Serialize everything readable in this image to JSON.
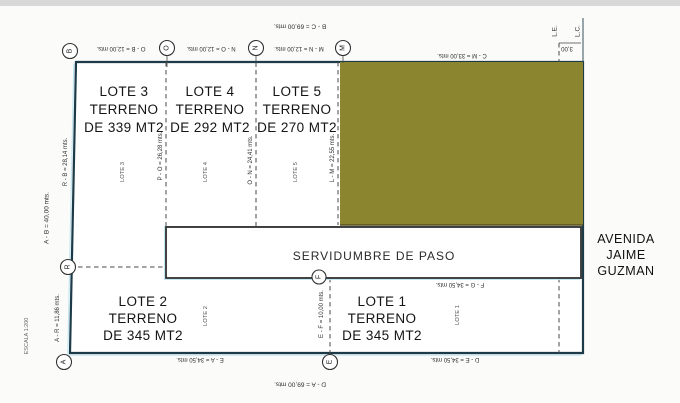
{
  "plan": {
    "servidumbre_label": "SERVIDUMBRE DE PASO",
    "avenue": {
      "l1": "AVENIDA",
      "l2": "JAIME",
      "l3": "GUZMAN"
    },
    "scale": "ESCALA 1:200",
    "lots": {
      "lote3": {
        "name": "LOTE 3",
        "l2": "TERRENO",
        "l3": "DE 339 MT2"
      },
      "lote4": {
        "name": "LOTE 4",
        "l2": "TERRENO",
        "l3": "DE 292 MT2"
      },
      "lote5": {
        "name": "LOTE 5",
        "l2": "TERRENO",
        "l3": "DE 270 MT2"
      },
      "lote2": {
        "name": "LOTE 2",
        "l2": "TERRENO",
        "l3": "DE 345 MT2"
      },
      "lote1": {
        "name": "LOTE 1",
        "l2": "TERRENO",
        "l3": "DE 345 MT2"
      }
    },
    "markers": {
      "b": "B",
      "o": "O",
      "n": "N",
      "m": "M",
      "r": "R",
      "a": "A",
      "e": "E",
      "f": "F"
    },
    "dims": {
      "bc": "B - C = 69,00 mts.",
      "ob": "O - B = 12,00 mts.",
      "no": "N - O = 12,00 mts.",
      "mn": "M - N = 12,00 mts.",
      "cm": "C - M = 33,00 mts.",
      "ab": "A - B = 40,00 mts.",
      "rb": "R - B = 28,14 mts.",
      "ar": "A - R = 11,86 mts.",
      "po": "P - O = 26,28 mts.",
      "on": "O - N = 24,41 mts.",
      "lm": "L - M = 22,55 mts.",
      "ef": "E - F = 10,00 mts.",
      "fg": "F - G = 34,50 mts.",
      "ea": "E - A = 34,50 mts.",
      "de": "D - E = 34,50 mts.",
      "da": "D - A = 69,00 mts.",
      "le": "L.E.",
      "lc": "L.C.",
      "setback": "3,00"
    },
    "colors": {
      "olive_fill": "#8c8530",
      "olive_border": "#56511f",
      "outline": "#1c3a47",
      "accent": "#c2e6f2",
      "band_border": "#2f2f2f",
      "top_strip": "#d8d8d8"
    }
  }
}
